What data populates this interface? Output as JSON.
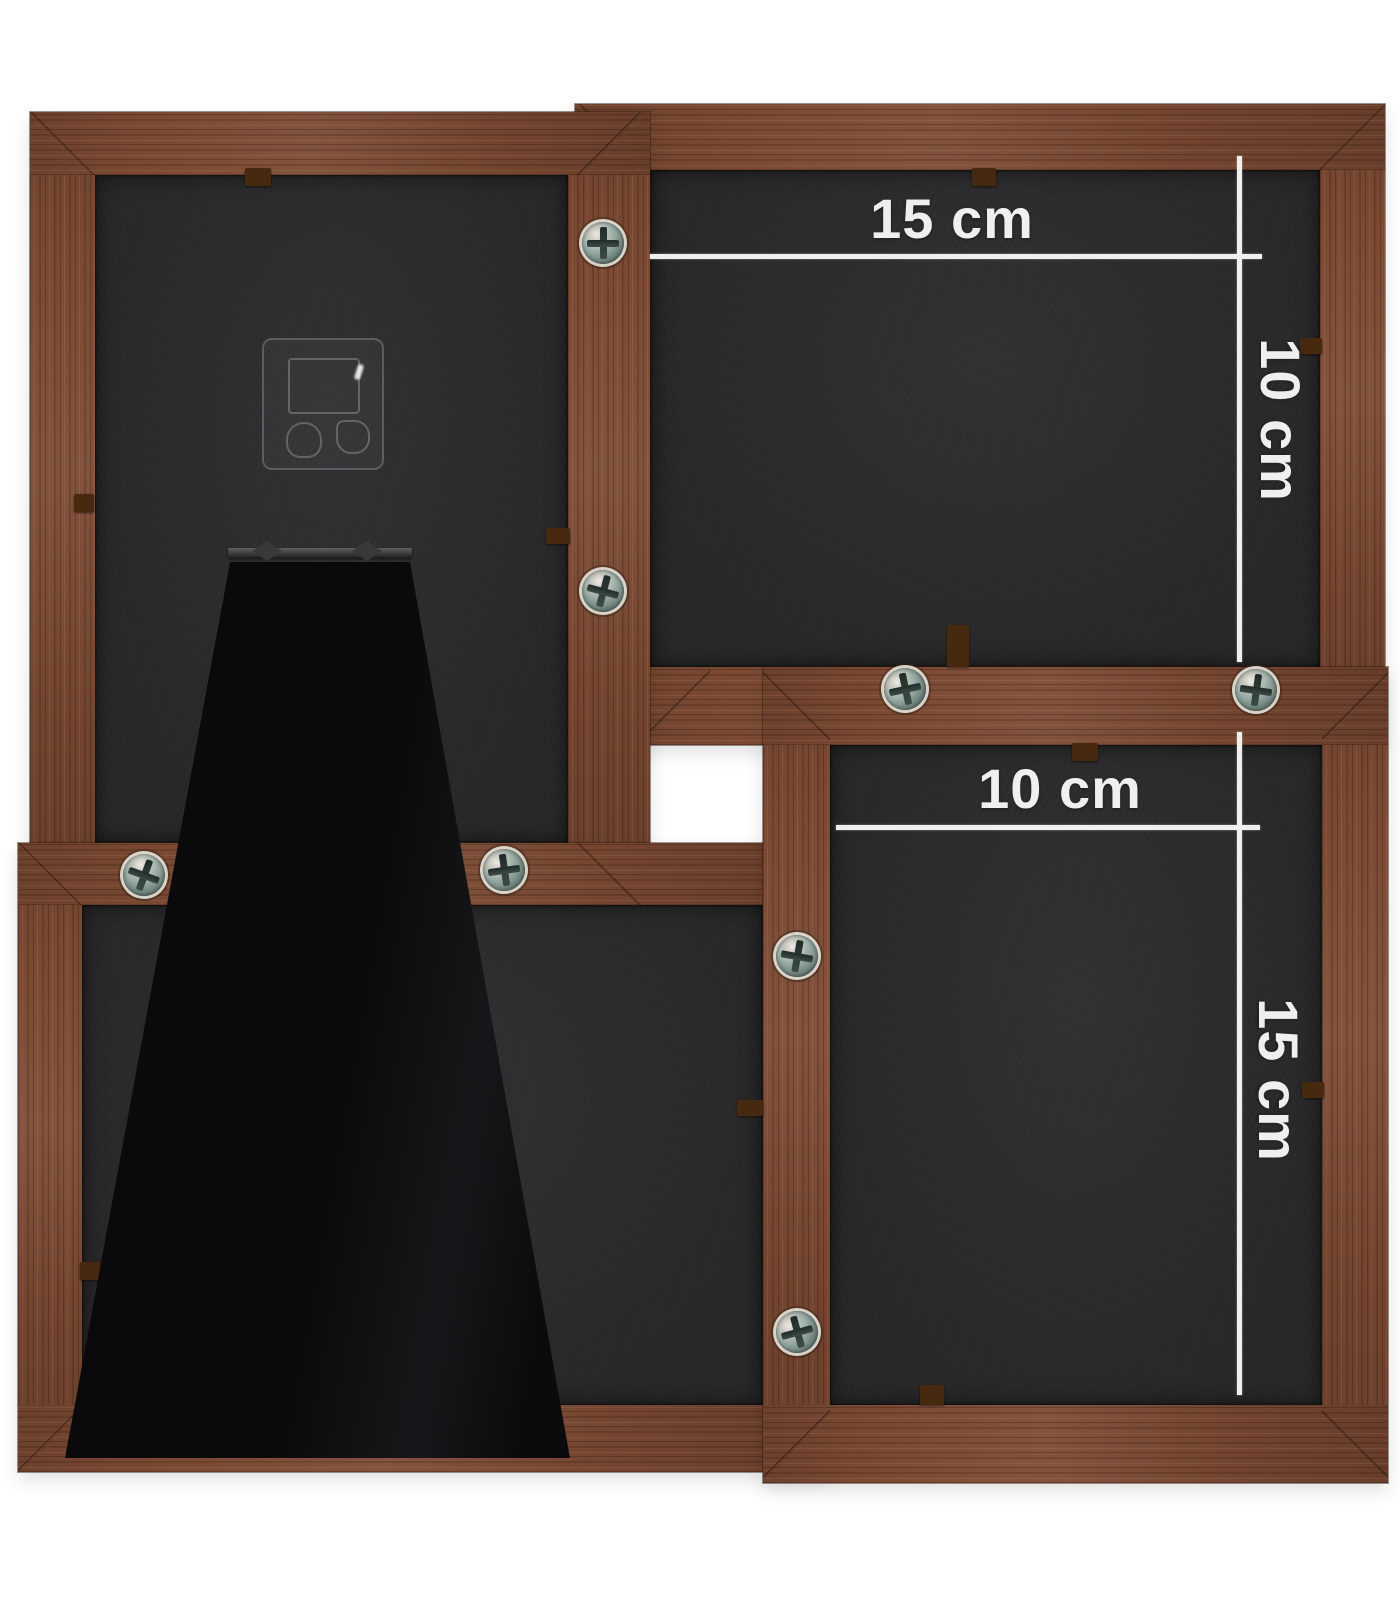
{
  "annotations": {
    "top_right_frame": {
      "width_label": "15 cm",
      "height_label": "10 cm"
    },
    "bottom_right_frame": {
      "width_label": "10 cm",
      "height_label": "15 cm"
    }
  },
  "hardware": {
    "screw_count": 8,
    "clip_count": 11
  },
  "colors": {
    "background": "#ffffff",
    "wood": "#7c4a33",
    "wood_dark": "#57331f",
    "wood_light": "#8f5c42",
    "backing": "#2a292b",
    "stand": "#0b0b0d",
    "dimension": "#f0efed"
  }
}
